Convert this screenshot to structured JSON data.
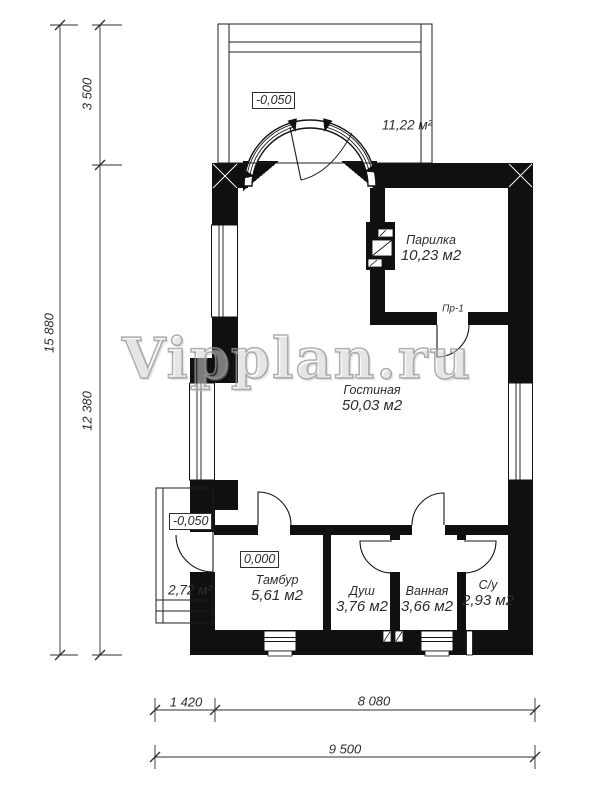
{
  "watermark": {
    "text": "Vipplan.ru"
  },
  "rooms": [
    {
      "name": "Парилка",
      "area": "10,23 м2"
    },
    {
      "name": "Гостиная",
      "area": "50,03 м2"
    },
    {
      "name": "Тамбур",
      "area": "5,61 м2"
    },
    {
      "name": "Душ",
      "area": "3,76 м2"
    },
    {
      "name": "Ванная",
      "area": "3,66 м2"
    },
    {
      "name": "С/у",
      "area": "2,93 м2"
    }
  ],
  "outdoor": {
    "terrace_area": "11,22 м²",
    "porch_area": "2,72 м²"
  },
  "elevations": {
    "terrace": "-0,050",
    "entry_floor": "0,000",
    "porch": "-0,050"
  },
  "doors": {
    "sauna_door_label": "Пр-1"
  },
  "dimensions": {
    "left_outer_total": "15 880",
    "left_top": "3 500",
    "left_bottom": "12 380",
    "bottom_porch": "1 420",
    "bottom_house": "8 080",
    "bottom_total": "9 500"
  }
}
